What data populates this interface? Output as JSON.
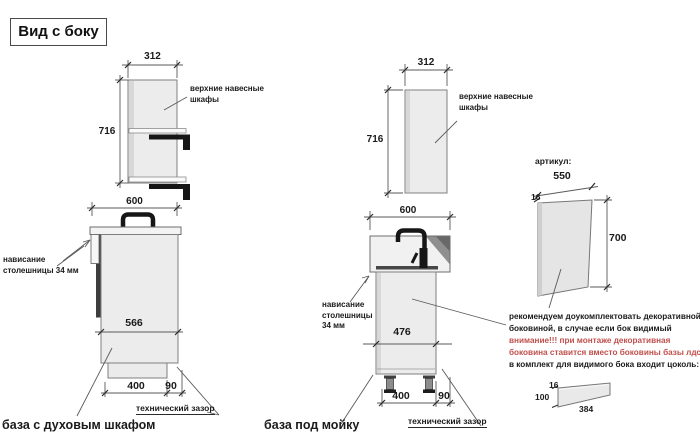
{
  "title": "Вид с боку",
  "colors": {
    "warning_red": "#c0504d",
    "cabinet_fill": "#ececec",
    "line": "#7f7f7f",
    "hardware_black": "#161616"
  },
  "left": {
    "upper": {
      "width": "312",
      "height": "716",
      "label": "верхние навесные шкафы"
    },
    "base": {
      "width": "600",
      "depth": "566",
      "front_dim": "400",
      "gap_dim": "90",
      "overhang_label": "нависание столешницы 34 мм",
      "gap_label": "технический зазор",
      "name": "база с духовым шкафом"
    }
  },
  "mid": {
    "upper": {
      "width": "312",
      "height": "716",
      "label": "верхние навесные шкафы"
    },
    "base": {
      "width": "600",
      "depth": "476",
      "front_dim": "400",
      "gap_dim": "90",
      "overhang_label": "нависание столешницы 34 мм",
      "gap_label": "технический зазор",
      "name": "база под мойку"
    }
  },
  "right": {
    "article_label": "артикул:",
    "panel": {
      "width": "550",
      "thickness": "16",
      "height": "700"
    },
    "note": {
      "line1": "рекомендуем доукомплектовать декоративной",
      "line2": "боковиной, в случае если бок видимый",
      "line3": "внимание!!! при монтаже декоративная",
      "line4": "боковина ставится вместо боковины базы лдсп",
      "line5": "в комплект для видимого бока входит цоколь:"
    },
    "plinth": {
      "thickness": "16",
      "height": "100",
      "length": "384"
    }
  }
}
